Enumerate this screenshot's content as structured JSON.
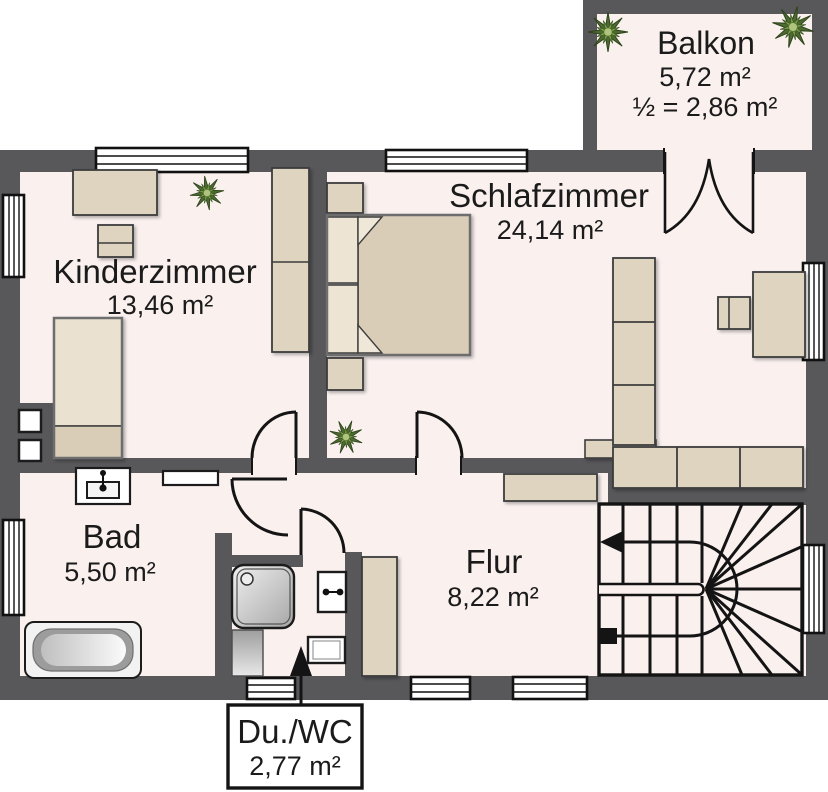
{
  "plan": {
    "rooms": {
      "balkon": {
        "name": "Balkon",
        "area": "5,72 m²",
        "half_area": "½ = 2,86 m²"
      },
      "schlafzimmer": {
        "name": "Schlafzimmer",
        "area": "24,14 m²"
      },
      "kinderzimmer": {
        "name": "Kinderzimmer",
        "area": "13,46 m²"
      },
      "bad": {
        "name": "Bad",
        "area": "5,50 m²"
      },
      "flur": {
        "name": "Flur",
        "area": "8,22 m²"
      },
      "du_wc": {
        "name": "Du./WC",
        "area": "2,77 m²"
      }
    },
    "colors": {
      "wall": "#58585B",
      "floor": "#FAF1EF",
      "furniture": "#DFD4C0",
      "bed": "#D9CDB7",
      "pillow": "#EDE4D4",
      "outline": "#141414",
      "plant_dark": "#4C6B2F",
      "plant_light": "#7FA04E"
    },
    "icons": {
      "plant": "plant-icon",
      "stairs_direction": "arrow-left-icon",
      "callout_pointer": "arrow-up-icon"
    }
  }
}
